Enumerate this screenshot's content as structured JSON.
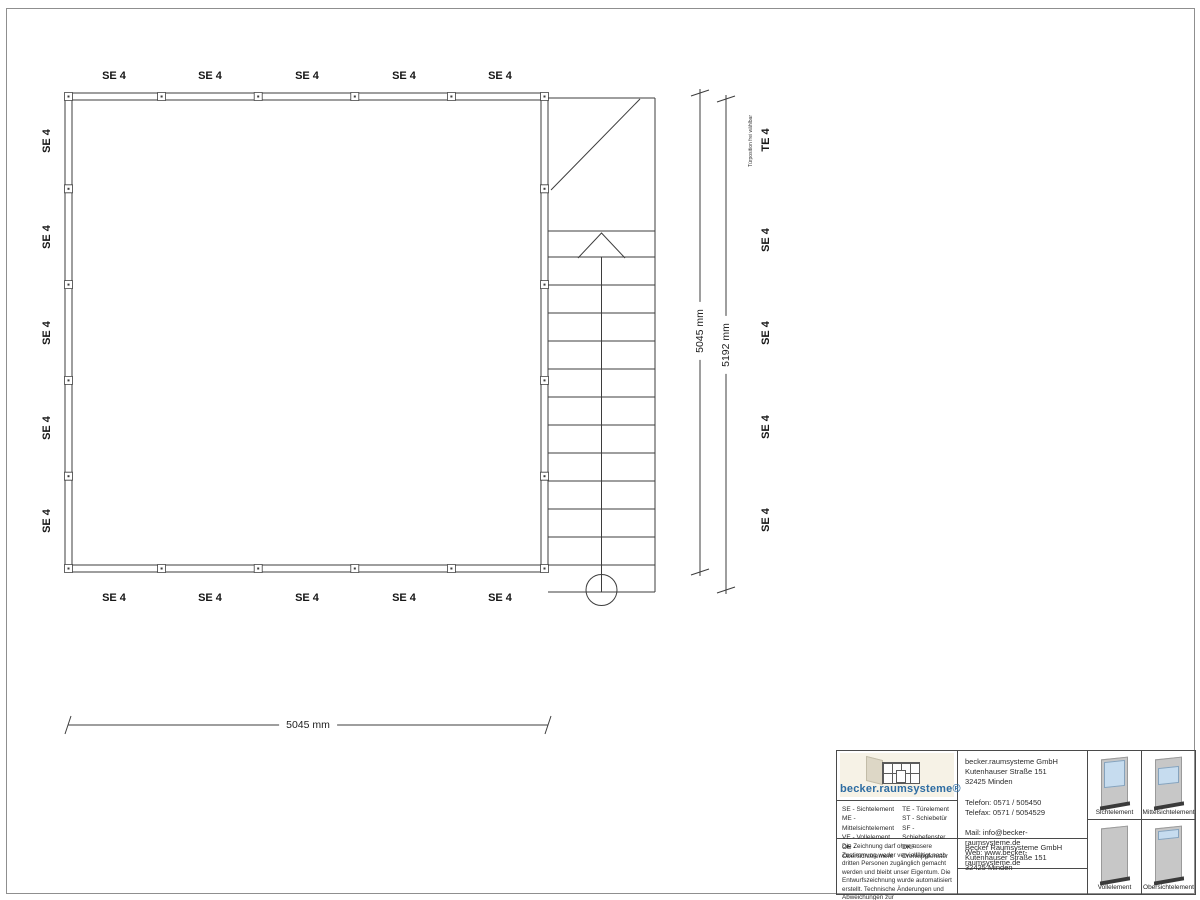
{
  "plan": {
    "element_labels": {
      "top": [
        "SE 4",
        "SE 4",
        "SE 4",
        "SE 4",
        "SE 4"
      ],
      "bottom": [
        "SE 4",
        "SE 4",
        "SE 4",
        "SE 4",
        "SE 4"
      ],
      "left": [
        "SE 4",
        "SE 4",
        "SE 4",
        "SE 4",
        "SE 4"
      ],
      "right": [
        "TE 4",
        "SE 4",
        "SE 4",
        "SE 4",
        "SE 4"
      ]
    },
    "door_note": "Türposition frei wählbar",
    "dimensions": {
      "horizontal_bottom": "5045 mm",
      "vertical_inner": "5045 mm",
      "vertical_outer": "5192 mm"
    }
  },
  "title_block": {
    "logo_text": "becker.raumsysteme®",
    "legend_left": [
      "SE - Sichtelement",
      "ME - Mittelsichtelement",
      "VE - Vollelement",
      "OE - Obersichtelement"
    ],
    "legend_right": [
      "TE - Türelement",
      "ST - Schiebetür",
      "SF - Schiebefenster",
      "DKF - Drehkippfenster"
    ],
    "disclaimer": "Die Zeichnung darf ohne unsere Zustimmung weder vervielfältigt noch dritten Personen zugänglich gemacht werden und bleibt unser Eigentum. Die Entwurfszeichnung wurde automatisiert erstellt. Technische Änderungen und Abweichungen zur Ausführungszeichnung behalten wir uns vor.",
    "contact": "becker.raumsysteme GmbH\nKutenhauser Straße 151\n32425 Minden\n\nTelefon: 0571 / 505450\nTelefax: 0571 / 5054529\n\nMail: info@becker-raumsysteme.de\nWeb: www.becker-raumsysteme.de",
    "owner": "Becker Raumsysteme GmbH\nKutenhauser Straße 151\n32425 Minden",
    "thumbnails": [
      "Sichtelement",
      "Mittelsichtelement",
      "Vollelement",
      "Obersichtelement"
    ],
    "colors": {
      "glass": "#c6dcef",
      "panel_gray": "#c7c7c7",
      "base_dark": "#3a3a3a",
      "logo_blue": "#2d6ca2",
      "logo_bg": "#f6f2e6"
    }
  }
}
